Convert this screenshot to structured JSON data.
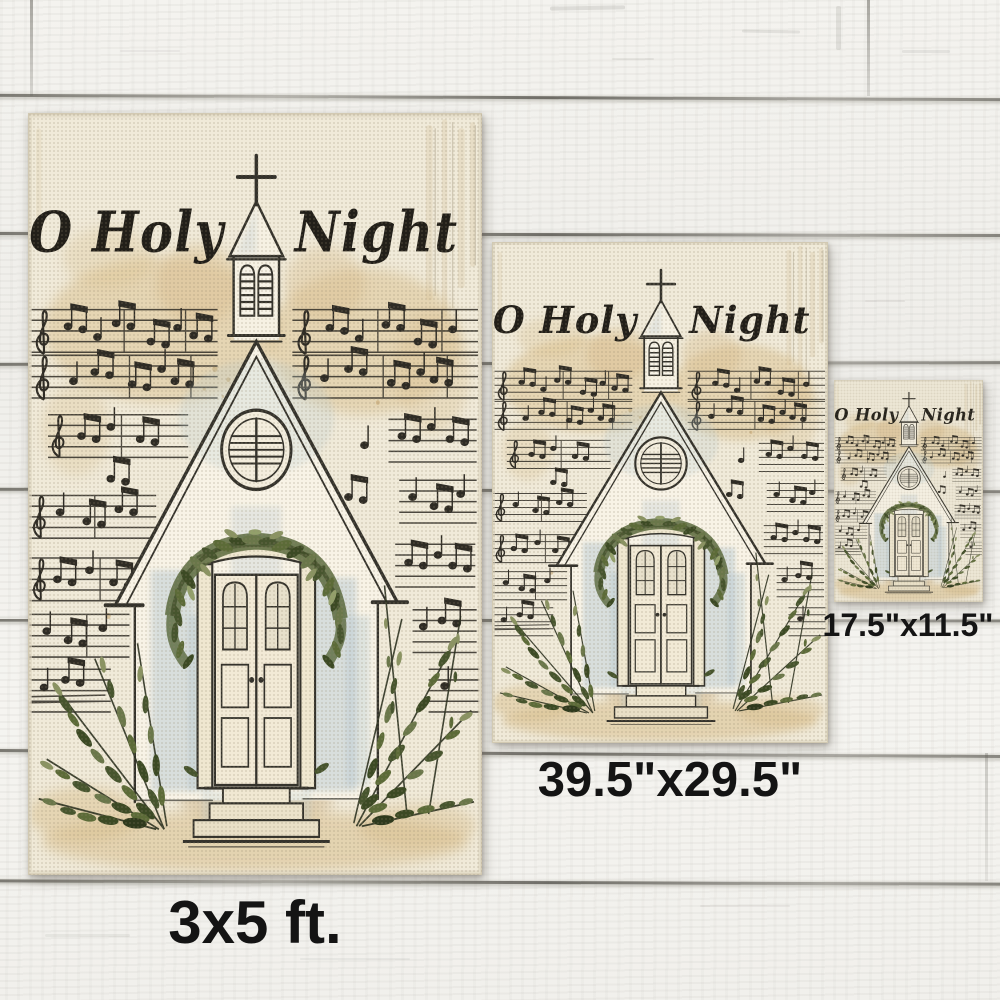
{
  "artwork": {
    "title_left": "O Holy",
    "title_right": "Night"
  },
  "variants": [
    {
      "name": "large",
      "size_label": "3x5 ft."
    },
    {
      "name": "medium",
      "size_label": "39.5\"x29.5\""
    },
    {
      "name": "small",
      "size_label": "17.5\"x11.5\""
    }
  ],
  "palette": {
    "wood": "#f2f1ec",
    "plank_gap": "#5f5c54",
    "canvas": "#f0ead9",
    "tan_wash": "#d9bf8e",
    "blue_wash": "#b9cad1",
    "ink": "#35332c",
    "greenery_dark": "#3c4a24",
    "greenery_mid": "#5c6b38",
    "greenery_light": "#8a9362",
    "label_text": "#141414"
  }
}
